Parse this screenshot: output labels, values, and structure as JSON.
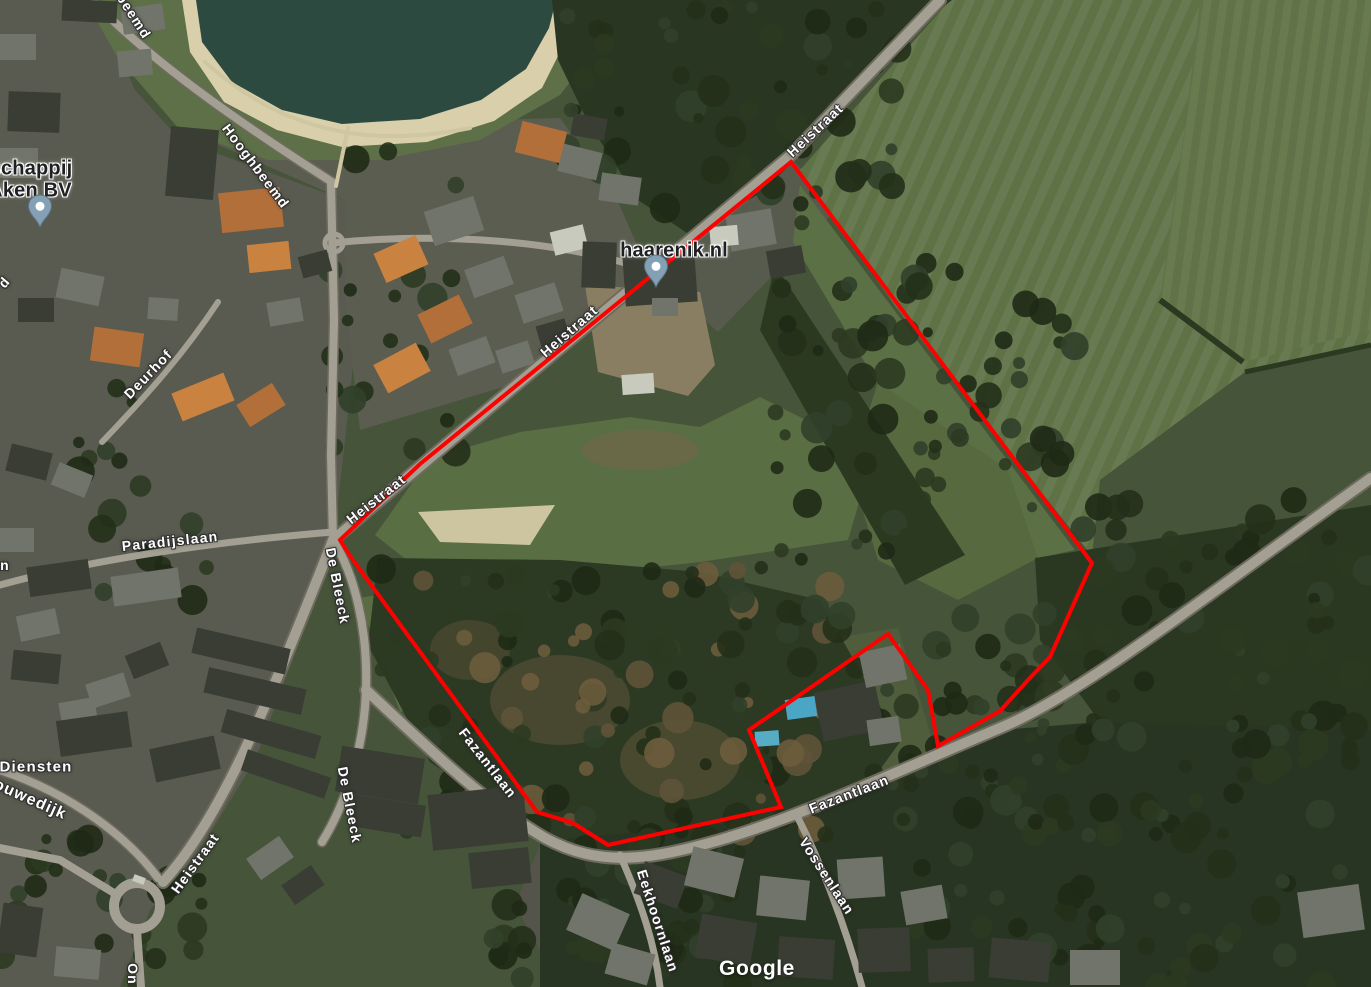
{
  "map": {
    "attribution": "Google",
    "attribution_pos": {
      "x": 757,
      "y": 969
    },
    "colors": {
      "parcel_outline": "#ff0000",
      "water": "#2c4a40",
      "sand": "#d9d0ab",
      "field": "#5e7246",
      "forest": "#283522",
      "road": "#a3a093",
      "pin_fill": "#83a0b5",
      "street_label": "#ffffff",
      "place_label": "#1f2023"
    },
    "parcel_outline": {
      "stroke_width": 4,
      "points": [
        [
          791,
          162
        ],
        [
          1092,
          563
        ],
        [
          1050,
          657
        ],
        [
          1028,
          680
        ],
        [
          1000,
          711
        ],
        [
          938,
          746
        ],
        [
          928,
          690
        ],
        [
          888,
          634
        ],
        [
          749,
          730
        ],
        [
          781,
          807
        ],
        [
          608,
          845
        ],
        [
          573,
          823
        ],
        [
          537,
          812
        ],
        [
          350,
          556
        ],
        [
          340,
          540
        ],
        [
          420,
          464
        ]
      ]
    },
    "street_labels": [
      {
        "text": "beemd",
        "x": 134,
        "y": 16,
        "rot": 57
      },
      {
        "text": "Hooghbeemd",
        "x": 256,
        "y": 166,
        "rot": 53
      },
      {
        "text": "Deurhof",
        "x": 148,
        "y": 374,
        "rot": -46
      },
      {
        "text": "Paradijslaan",
        "x": 170,
        "y": 541,
        "rot": -6
      },
      {
        "text": "De Bleeck",
        "x": 338,
        "y": 586,
        "rot": 79
      },
      {
        "text": "De Bleeck",
        "x": 350,
        "y": 805,
        "rot": 79
      },
      {
        "text": "Heistraat",
        "x": 815,
        "y": 130,
        "rot": -43
      },
      {
        "text": "Heistraat",
        "x": 569,
        "y": 331,
        "rot": -41
      },
      {
        "text": "Heistraat",
        "x": 376,
        "y": 499,
        "rot": -38
      },
      {
        "text": "Heistraat",
        "x": 195,
        "y": 863,
        "rot": -54
      },
      {
        "text": "Fazantlaan",
        "x": 488,
        "y": 763,
        "rot": 52
      },
      {
        "text": "Fazantlaan",
        "x": 849,
        "y": 794,
        "rot": -21
      },
      {
        "text": "Vossenlaan",
        "x": 827,
        "y": 876,
        "rot": 57
      },
      {
        "text": "Eekhoornlaan",
        "x": 658,
        "y": 921,
        "rot": 72
      },
      {
        "text": "Diensten",
        "x": 36,
        "y": 767,
        "rot": 0,
        "size": 15
      },
      {
        "text": "ouwedijk",
        "x": 30,
        "y": 800,
        "rot": 24,
        "size": 16
      },
      {
        "text": "n",
        "x": 5,
        "y": 565,
        "rot": 0
      },
      {
        "text": "d",
        "x": 4,
        "y": 282,
        "rot": -50
      },
      {
        "text": "On",
        "x": 133,
        "y": 974,
        "rot": 90
      }
    ],
    "place_labels": [
      {
        "text": "schappij",
        "x": 31,
        "y": 169
      },
      {
        "text": "Aken BV",
        "x": 30,
        "y": 191
      },
      {
        "text": "haarenik.nl",
        "x": 674,
        "y": 251
      }
    ],
    "pins": [
      {
        "x": 40,
        "y": 233
      },
      {
        "x": 656,
        "y": 293
      }
    ]
  }
}
